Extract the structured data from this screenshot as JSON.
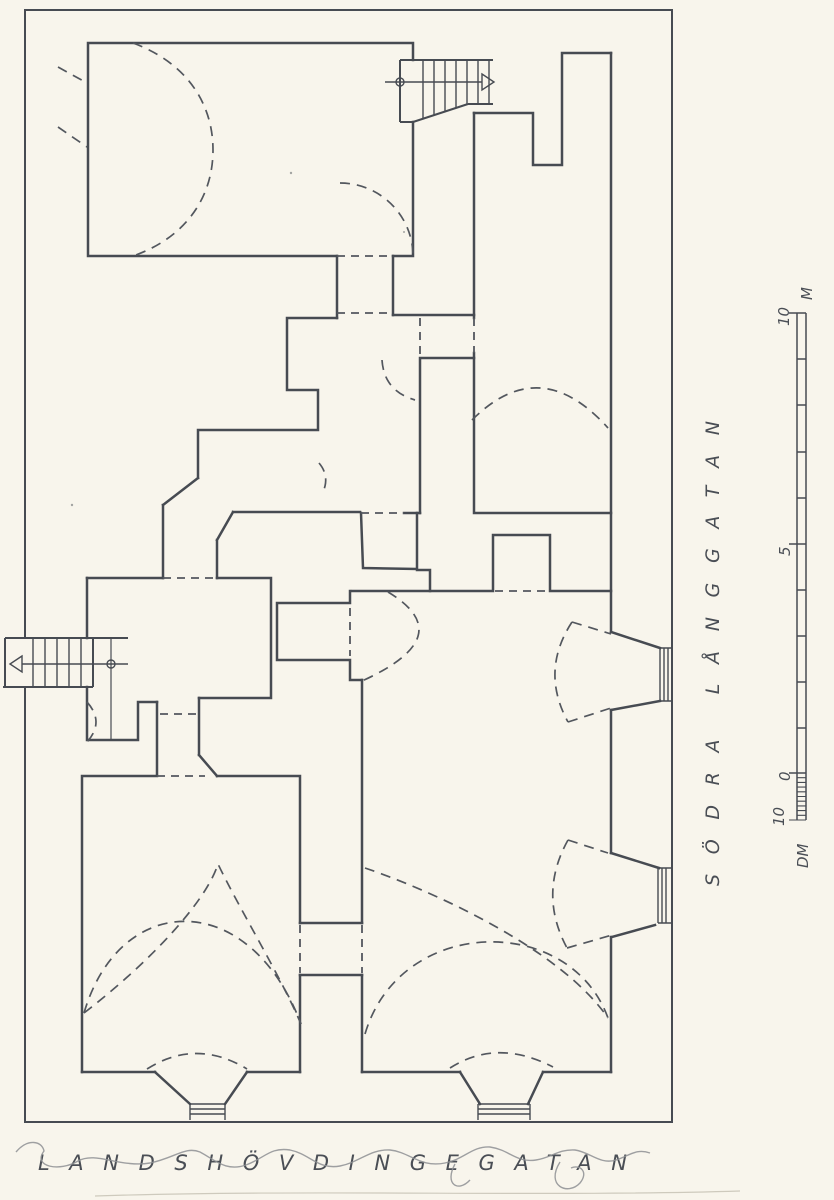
{
  "page": {
    "kind": "archival floor plan drawing",
    "background_color": "#f8f5ec",
    "ink_color": "#474b52",
    "pencil_color": "#8f9194"
  },
  "streets": {
    "right_vertical": "SÖDRA LÅNGGATAN",
    "bottom_horizontal": "LANDSHÖVDINGEGATAN"
  },
  "scale_bar": {
    "top_value": "10",
    "top_unit": "M",
    "mid_value": "5",
    "zero_value": "0",
    "sub_value": "10",
    "sub_unit": "DM"
  }
}
